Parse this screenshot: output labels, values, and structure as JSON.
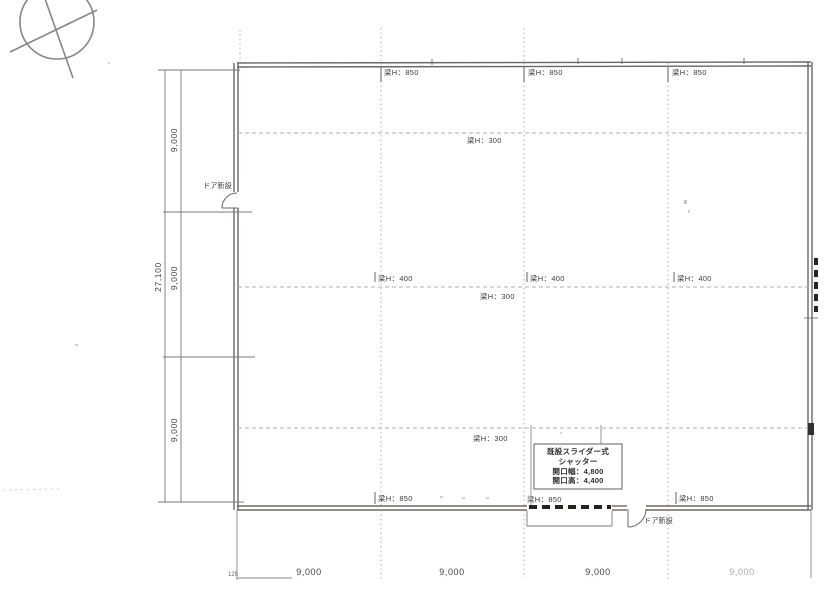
{
  "beam_labels": {
    "top_left": "梁H：850",
    "top_center": "梁H：850",
    "top_right": "梁H：850",
    "row1_300": "梁H：300",
    "mid_left_400": "梁H：400",
    "mid_center_400": "梁H：400",
    "mid_right_400": "梁H：400",
    "mid_300": "梁H：300",
    "row3_300": "梁H：300",
    "bottom_left": "梁H：850",
    "bottom_center": "梁H：850",
    "bottom_right": "梁H：850"
  },
  "dimensions": {
    "left_total": "27,100",
    "left_seg1": "9,000",
    "left_seg2": "9,000",
    "left_seg3": "9,000",
    "bottom_1": "9,000",
    "bottom_2": "9,000",
    "bottom_3": "9,000",
    "bottom_4": "9,000",
    "corner_note": "125"
  },
  "doors": {
    "left": "ドア新設",
    "bottom": "ドア新設"
  },
  "shutter_box": {
    "line1": "既設スライダー式",
    "line2": "シャッター",
    "line3": "開口幅：4,800",
    "line4": "開口高：4,400"
  },
  "colors": {
    "wall": "#6b6661",
    "grid": "#a9a5a0",
    "dim": "#7d7974",
    "text": "#3a3734"
  }
}
